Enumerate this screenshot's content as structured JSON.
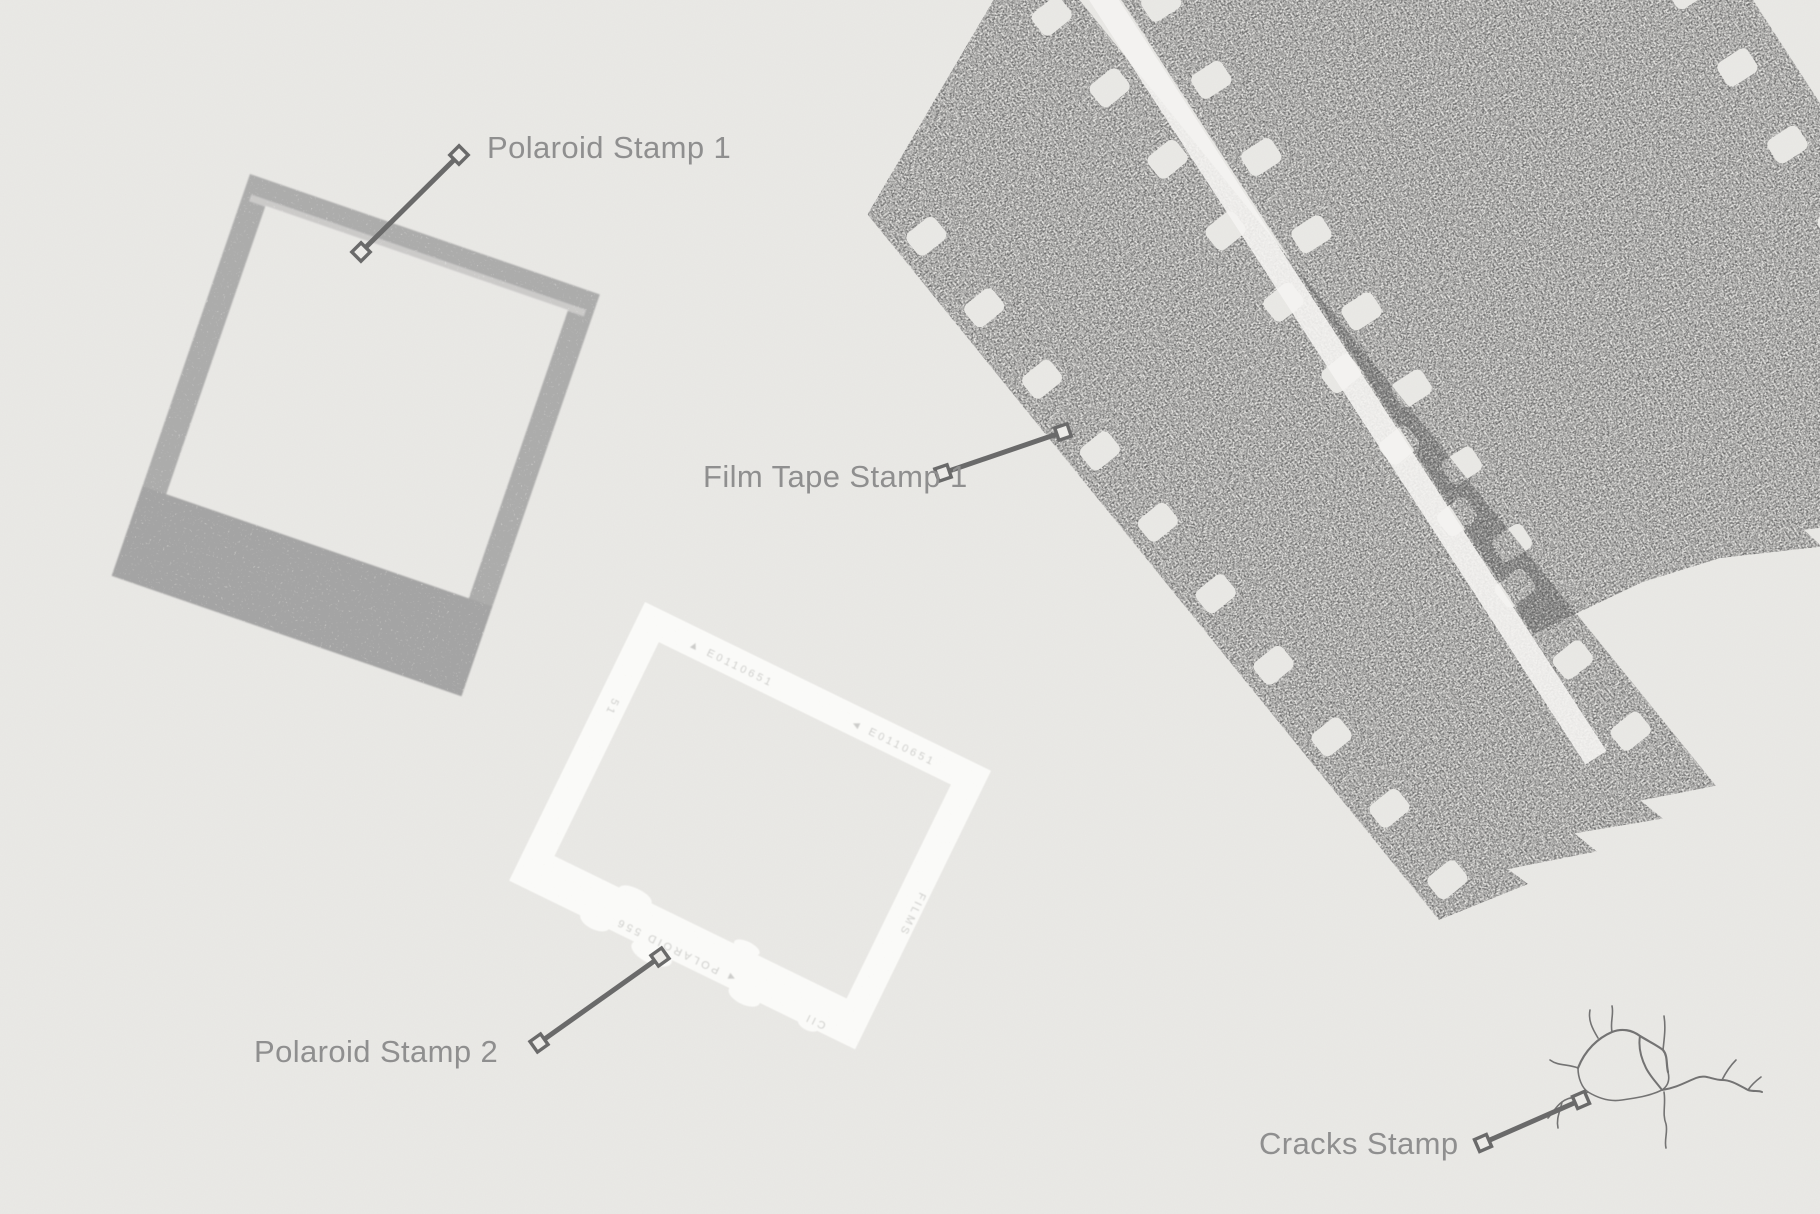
{
  "scene": {
    "title": "Stamp assets preview",
    "background_color": "#ecebe8"
  },
  "stamps": {
    "polaroid_1": {
      "label": "Polaroid Stamp 1"
    },
    "film_tape_1": {
      "label": "Film Tape Stamp 1"
    },
    "polaroid_2": {
      "label": "Polaroid Stamp 2",
      "markings": {
        "top_left": "▲ E0110651",
        "top_right": "◄ E0110651",
        "right_edge": "FILMS",
        "bottom_edge": "◄ POLAROID 556",
        "corner": "CII",
        "left_edge": "51"
      }
    },
    "cracks": {
      "label": "Cracks Stamp"
    }
  },
  "colors": {
    "label_text": "#8f8f8f",
    "leader_line": "#6a6a6a",
    "polaroid_gray": "#a2a2a2",
    "film_gray": "#606060",
    "frame_white": "#fafaf8",
    "crack_gray": "#575757"
  }
}
